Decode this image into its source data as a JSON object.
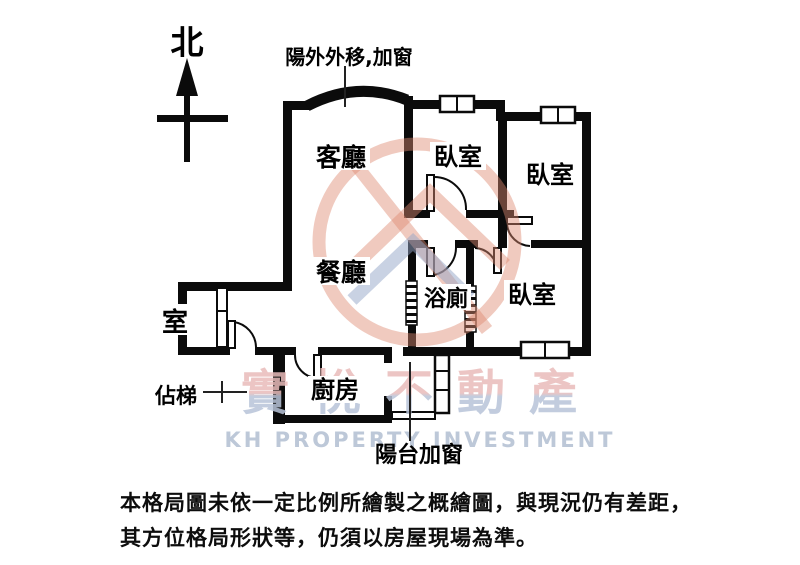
{
  "compass": {
    "north_label": "北"
  },
  "annotations": {
    "top_note": "陽外外移,加窗",
    "balcony_note": "陽台加窗",
    "stairs_note": "佔梯"
  },
  "rooms": {
    "living": "客廳",
    "dining": "餐廳",
    "bedroom1": "臥室",
    "bedroom2": "臥室",
    "bedroom3": "臥室",
    "bathroom": "浴廁",
    "kitchen": "廚房",
    "small_room": "室"
  },
  "watermark": {
    "brand": "實悅不動產",
    "subtitle": "KH PROPERTY INVESTMENT",
    "brand_top_color": "#e9bcba",
    "brand_bottom_color": "#b8c4d9",
    "logo_color": "#dd8a70",
    "logo_blue_color": "#93a5c8"
  },
  "disclaimer": {
    "line1": "本格局圖未依一定比例所繪製之概繪圖，與現況仍有差距，",
    "line2": "其方位格局形狀等，仍須以房屋現場為準。"
  }
}
